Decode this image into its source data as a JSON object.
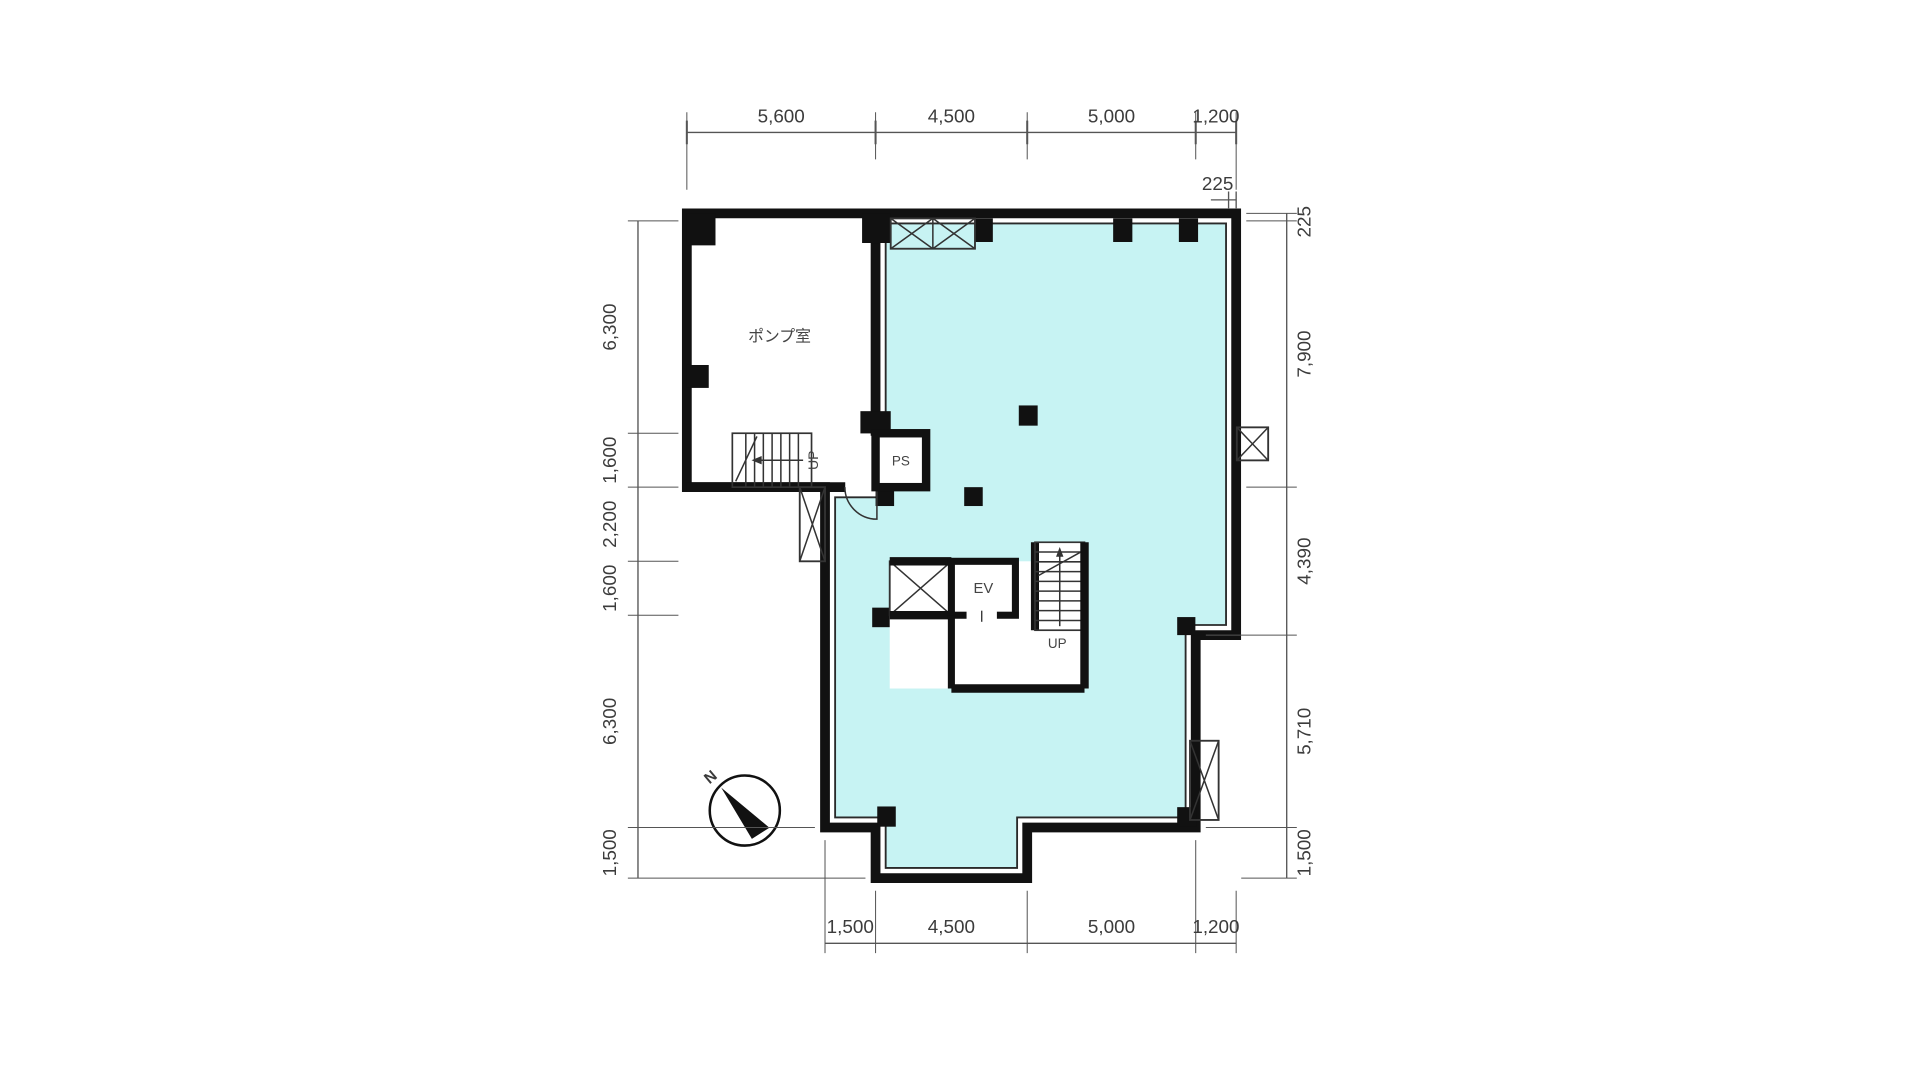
{
  "plan": {
    "type": "architectural-floor-plan",
    "rooms": {
      "pump_room": "ポンプ室",
      "pipe_shaft": "PS",
      "elevator": "EV"
    },
    "labels": {
      "up_main_stairs": "UP",
      "up_core_stairs": "UP",
      "north": "N"
    },
    "dimensions": {
      "top": [
        "5,600",
        "4,500",
        "5,000",
        "1,200"
      ],
      "top_wall_offset": "225",
      "right": [
        "225",
        "7,900",
        "4,390",
        "5,710",
        "1,500"
      ],
      "left": [
        "6,300",
        "1,600",
        "2,200",
        "1,600",
        "6,300",
        "1,500"
      ],
      "bottom": [
        "1,500",
        "4,500",
        "5,000",
        "1,200"
      ]
    },
    "colors": {
      "floor_fill": "#c7f3f3",
      "wall": "#111111",
      "dim_text": "#3c3c3c"
    }
  }
}
